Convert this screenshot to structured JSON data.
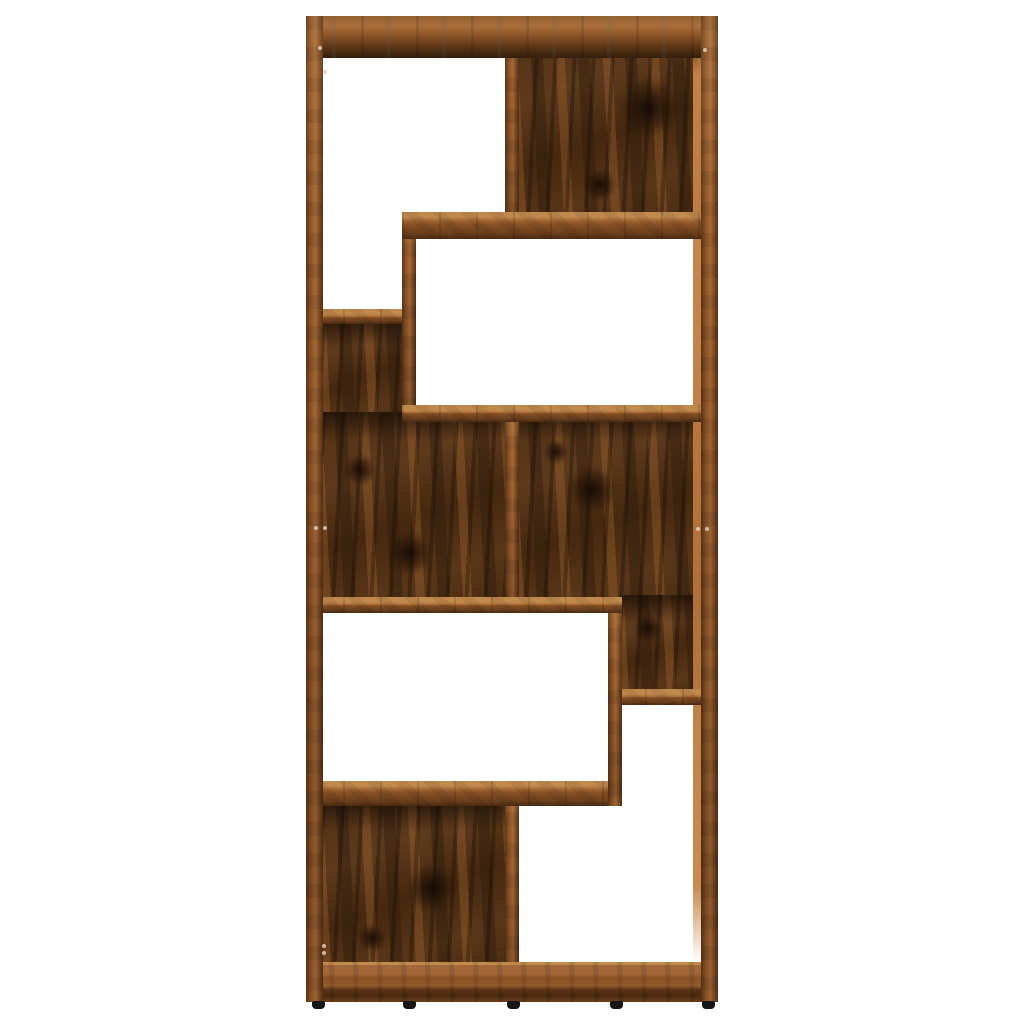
{
  "scene": {
    "background": "#ffffff",
    "colors": {
      "frame_base": "#8a5226",
      "frame_light": "#a86a36",
      "frame_dark": "#573114",
      "edge_hi": "#c08a4d",
      "back_base": "#4e2f15",
      "back_light": "#a0622a",
      "knot_color": "#160b04",
      "foot": "#161616",
      "inner_face": "#c8854a"
    },
    "furniture": {
      "x": 306,
      "y": 16,
      "width": 412,
      "height": 986
    },
    "back_panels": [
      {
        "name": "back-panel-top-right",
        "x": 517,
        "y": 30,
        "w": 186,
        "h": 185
      },
      {
        "name": "back-panel-mid-left-upper",
        "x": 322,
        "y": 318,
        "w": 82,
        "h": 106
      },
      {
        "name": "back-panel-mid-left-lower",
        "x": 322,
        "y": 412,
        "w": 185,
        "h": 190
      },
      {
        "name": "back-panel-mid-right-upper",
        "x": 515,
        "y": 412,
        "w": 188,
        "h": 190
      },
      {
        "name": "back-panel-mid-right-lower",
        "x": 620,
        "y": 595,
        "w": 83,
        "h": 100
      },
      {
        "name": "back-panel-bottom-left",
        "x": 322,
        "y": 802,
        "w": 185,
        "h": 165
      }
    ],
    "knots": [
      {
        "x": 649,
        "y": 108,
        "r": 30
      },
      {
        "x": 600,
        "y": 185,
        "r": 16
      },
      {
        "x": 360,
        "y": 470,
        "r": 16
      },
      {
        "x": 410,
        "y": 553,
        "r": 22
      },
      {
        "x": 592,
        "y": 490,
        "r": 24
      },
      {
        "x": 556,
        "y": 452,
        "r": 12
      },
      {
        "x": 648,
        "y": 628,
        "r": 14
      },
      {
        "x": 432,
        "y": 888,
        "r": 24
      },
      {
        "x": 372,
        "y": 938,
        "r": 14
      }
    ],
    "inner_face": {
      "name": "right-panel-inner-face",
      "x": 693,
      "y": 34,
      "w": 8,
      "h": 928
    },
    "boards": [
      {
        "name": "shelf-right-step",
        "type": "h",
        "x": 608,
        "y": 689,
        "w": 110,
        "h": 16
      },
      {
        "name": "divider-top",
        "type": "v",
        "x": 505,
        "y": 16,
        "w": 14,
        "h": 223
      },
      {
        "name": "divider-middle",
        "type": "v",
        "x": 505,
        "y": 405,
        "w": 14,
        "h": 208
      },
      {
        "name": "divider-bottom",
        "type": "v",
        "x": 505,
        "y": 781,
        "w": 14,
        "h": 221
      },
      {
        "name": "shelf-lower-left",
        "type": "h",
        "x": 306,
        "y": 781,
        "w": 316,
        "h": 25
      },
      {
        "name": "divider-step-lower",
        "type": "v",
        "x": 608,
        "y": 597,
        "w": 14,
        "h": 209
      },
      {
        "name": "shelf-upper-left",
        "type": "h",
        "x": 306,
        "y": 309,
        "w": 110,
        "h": 15
      },
      {
        "name": "divider-step-upper",
        "type": "v",
        "x": 402,
        "y": 212,
        "w": 14,
        "h": 210
      },
      {
        "name": "shelf-upper-right",
        "type": "h",
        "x": 402,
        "y": 212,
        "w": 316,
        "h": 27
      },
      {
        "name": "shelf-middle-upper",
        "type": "h",
        "x": 402,
        "y": 405,
        "w": 316,
        "h": 17
      },
      {
        "name": "shelf-middle-lower",
        "type": "h",
        "x": 306,
        "y": 597,
        "w": 316,
        "h": 16
      },
      {
        "name": "top-board",
        "type": "top",
        "x": 306,
        "y": 16,
        "w": 412,
        "h": 42
      },
      {
        "name": "bottom-board",
        "type": "bottom",
        "x": 306,
        "y": 962,
        "w": 412,
        "h": 40
      },
      {
        "name": "left-side-panel",
        "type": "v",
        "x": 306,
        "y": 16,
        "w": 17,
        "h": 986
      },
      {
        "name": "right-side-panel",
        "type": "v",
        "x": 701,
        "y": 16,
        "w": 17,
        "h": 986
      }
    ],
    "feet": [
      {
        "x": 312,
        "y": 1001,
        "w": 13,
        "h": 8
      },
      {
        "x": 403,
        "y": 1001,
        "w": 13,
        "h": 8
      },
      {
        "x": 507,
        "y": 1001,
        "w": 13,
        "h": 8
      },
      {
        "x": 610,
        "y": 1001,
        "w": 13,
        "h": 8
      },
      {
        "x": 702,
        "y": 1001,
        "w": 13,
        "h": 8
      }
    ],
    "dots": [
      {
        "x": 320,
        "y": 48
      },
      {
        "x": 325,
        "y": 72
      },
      {
        "x": 705,
        "y": 50
      },
      {
        "x": 316,
        "y": 528
      },
      {
        "x": 325,
        "y": 528
      },
      {
        "x": 698,
        "y": 529
      },
      {
        "x": 707,
        "y": 529
      },
      {
        "x": 324,
        "y": 946
      },
      {
        "x": 324,
        "y": 953
      }
    ]
  }
}
